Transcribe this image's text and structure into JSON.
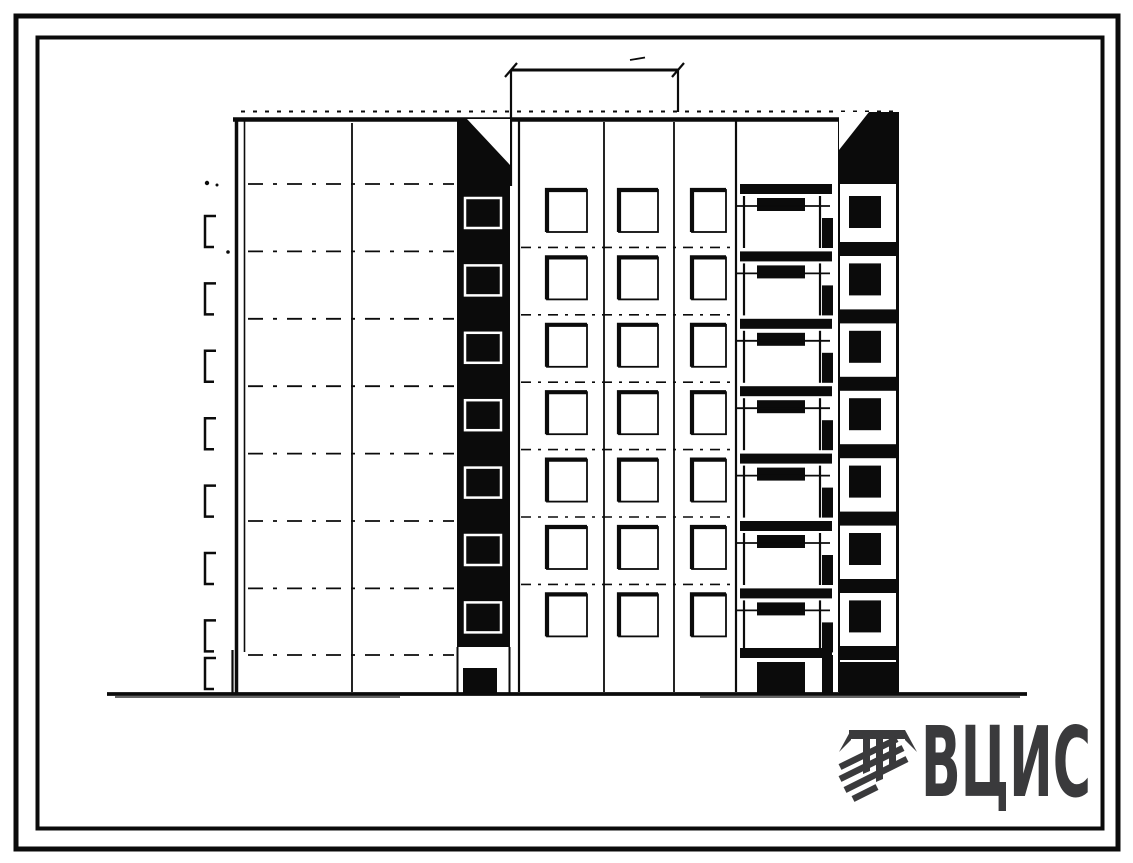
{
  "document": {
    "kind": "Scanned architectural elevation drawing of a multi-storey panel apartment building",
    "paper_color": "#ffffff",
    "ink_color": "#0b0b0b",
    "has_outer_border": true,
    "has_inner_border": true
  },
  "drawing": {
    "floors": 7,
    "window_columns": 3,
    "balcony_tiers": 7,
    "floor_level_marks": 8,
    "sections": [
      "blank-end-wall",
      "dark-stair-shaft",
      "window-grid",
      "balconies",
      "end-loggia-strip"
    ],
    "has_top_dimension_line": true,
    "has_ground_line": true
  },
  "logo": {
    "text": "ВЦИС",
    "color": "#3a3a3c",
    "emblem": "column-capital-with-diagonal-stripes"
  }
}
